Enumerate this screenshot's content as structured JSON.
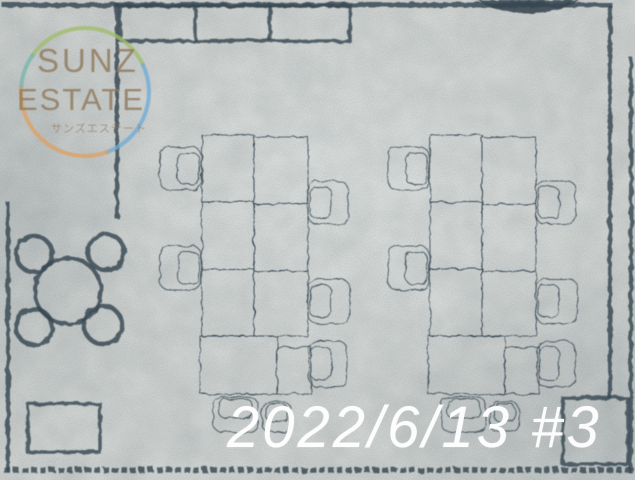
{
  "watermark": {
    "line1": "SUNZ",
    "line2": "ESTATE",
    "line3": "サンズエステート"
  },
  "stamp": {
    "text": "2022/6/13 #3"
  },
  "colors": {
    "paper": "#d9dcda",
    "paper_light": "#e4e7e5",
    "paper_dark": "#c6cbca",
    "ink": "#3c4c58",
    "watermark_text": "#90775a",
    "ring_green": "#a2bd6c",
    "ring_blue": "#72add6",
    "ring_orange": "#dda266",
    "ring_teal": "#79b7ad",
    "stamp_text": "#ffffff"
  }
}
